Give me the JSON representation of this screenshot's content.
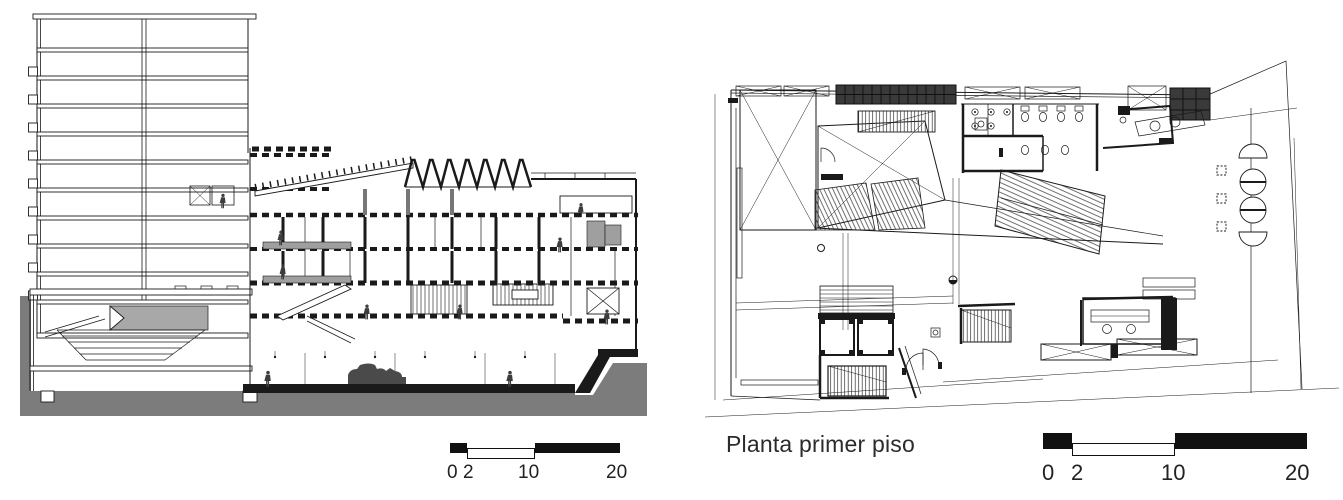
{
  "section_figure": {
    "scale_labels": [
      "0",
      "2",
      "10",
      "20"
    ]
  },
  "plan_figure": {
    "caption": "Planta primer piso",
    "scale_labels": [
      "0",
      "2",
      "10",
      "20"
    ]
  },
  "colors": {
    "ink": "#1a1a1a",
    "ground_gray": "#7c7c7c",
    "dark_fill": "#3a3a3a",
    "panel_gray": "#9f9f9f"
  }
}
